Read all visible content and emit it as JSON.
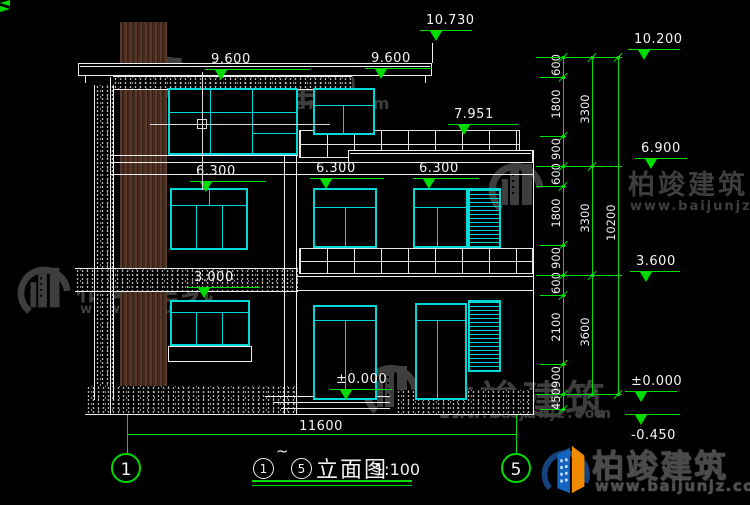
{
  "company": "柏竣建筑",
  "website": "www.baijunjz.com",
  "title_bar": {
    "start_bubble": "1",
    "tilde": "~",
    "end_bubble": "5",
    "drawing_name": "立面图",
    "scale_label": "1:100"
  },
  "grid_bubbles": [
    {
      "label": "1"
    },
    {
      "label": "5"
    }
  ],
  "bottom_dimension": {
    "value": "11600"
  },
  "elevation_markers": [
    {
      "label": "10.730",
      "x": 420,
      "y": 30,
      "w": 52
    },
    {
      "label": "9.600",
      "x": 205,
      "y": 69,
      "w": 105
    },
    {
      "label": "9.600",
      "x": 365,
      "y": 68,
      "w": 67
    },
    {
      "label": "7.951",
      "x": 448,
      "y": 124,
      "w": 70
    },
    {
      "label": "6.300",
      "x": 190,
      "y": 181,
      "w": 76
    },
    {
      "label": "6.300",
      "x": 310,
      "y": 178,
      "w": 74
    },
    {
      "label": "6.300",
      "x": 413,
      "y": 178,
      "w": 66
    },
    {
      "label": "3.000",
      "x": 188,
      "y": 287,
      "w": 72
    },
    {
      "label": "±0.000",
      "x": 330,
      "y": 389,
      "w": 62
    },
    {
      "label": "10.200",
      "x": 628,
      "y": 49,
      "w": 52
    },
    {
      "label": "6.900",
      "x": 635,
      "y": 158,
      "w": 52
    },
    {
      "label": "3.600",
      "x": 630,
      "y": 271,
      "w": 50
    },
    {
      "label": "±0.000",
      "x": 625,
      "y": 391,
      "w": 52
    },
    {
      "label": "-0.450",
      "x": 625,
      "y": 414,
      "w": 55,
      "below": true
    }
  ],
  "dim_chains": [
    {
      "x": 563,
      "y1": 57,
      "y2": 409,
      "ticks": [
        57,
        77,
        136,
        166,
        186,
        245,
        275,
        295,
        364,
        394,
        409
      ],
      "labels": [
        {
          "text": "600",
          "y": 67
        },
        {
          "text": "1800",
          "y": 106
        },
        {
          "text": "900",
          "y": 151
        },
        {
          "text": "600",
          "y": 176
        },
        {
          "text": "1800",
          "y": 215
        },
        {
          "text": "900",
          "y": 260
        },
        {
          "text": "600",
          "y": 285
        },
        {
          "text": "2100",
          "y": 329
        },
        {
          "text": "900",
          "y": 379
        },
        {
          "text": "450",
          "y": 401
        }
      ]
    },
    {
      "x": 592,
      "y1": 57,
      "y2": 394,
      "ticks": [
        57,
        166,
        275,
        394
      ],
      "labels": [
        {
          "text": "3300",
          "y": 111
        },
        {
          "text": "3300",
          "y": 220
        },
        {
          "text": "3600",
          "y": 334
        }
      ]
    },
    {
      "x": 618,
      "y1": 57,
      "y2": 394,
      "ticks": [
        57,
        394
      ],
      "labels": [
        {
          "text": "10200",
          "y": 225
        }
      ]
    }
  ],
  "level_lines": [
    {
      "y": 57,
      "x1": 536,
      "x2": 622
    },
    {
      "y": 77,
      "x1": 540,
      "x2": 566
    },
    {
      "y": 136,
      "x1": 540,
      "x2": 566
    },
    {
      "y": 166,
      "x1": 536,
      "x2": 622
    },
    {
      "y": 186,
      "x1": 536,
      "x2": 566
    },
    {
      "y": 245,
      "x1": 540,
      "x2": 566
    },
    {
      "y": 275,
      "x1": 536,
      "x2": 622
    },
    {
      "y": 295,
      "x1": 540,
      "x2": 566
    },
    {
      "y": 364,
      "x1": 540,
      "x2": 566
    },
    {
      "y": 394,
      "x1": 536,
      "x2": 622
    },
    {
      "y": 409,
      "x1": 540,
      "x2": 566
    }
  ],
  "watermarks": [
    {
      "lx": 138,
      "ly": 50,
      "lh": 58,
      "tx": 192,
      "ty": 56,
      "ts": 40,
      "wx": 196,
      "wy": 94,
      "ws": 16
    },
    {
      "lx": 487,
      "ly": 156,
      "lh": 60,
      "tx": 628,
      "ty": 163,
      "ts": 27,
      "wx": 630,
      "wy": 199,
      "ws": 13
    },
    {
      "lx": 16,
      "ly": 260,
      "lh": 58,
      "tx": 76,
      "ty": 263,
      "ts": 32,
      "wx": 80,
      "wy": 302,
      "ws": 13
    },
    {
      "lx": 362,
      "ly": 358,
      "lh": 60,
      "tx": 436,
      "ty": 368,
      "ts": 40,
      "wx": 438,
      "wy": 406,
      "ws": 14
    }
  ],
  "colors": {
    "background": "#000000",
    "line_white": "#ededed",
    "accent_green": "#00dc00",
    "window_cyan": "#00d8d8",
    "wood_brown": "#4a2d1f",
    "watermark_gray": "#3e3e3e",
    "logo_blue": "#1565c0",
    "logo_orange": "#f28a00",
    "logo_swoosh": "#16427e"
  }
}
